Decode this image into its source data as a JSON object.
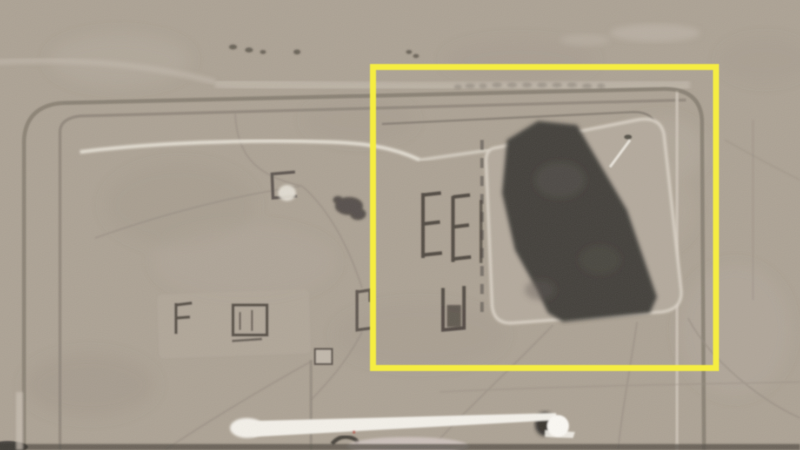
{
  "image": {
    "kind": "annotated satellite photo still",
    "alt": "Grainy monochrome overhead satellite view of a bermed desert compound with small E-shaped and U-shaped revetment structures, a large dark irregular disturbed/burned area on a lighter pad, a white dome building and a long thin white streak near the bottom. A yellow rectangle annotation highlights the dark area and adjacent structures.",
    "features": [
      "compound-perimeter-berm",
      "perimeter-road",
      "e-shaped-revetments",
      "u-shaped-revetment",
      "building-cluster",
      "dark-disturbed-area",
      "revetted-pad",
      "white-dome",
      "white-streak",
      "faint-watermark"
    ],
    "annotation": {
      "shape": "rectangle",
      "color": "#f5ed42",
      "x": 373,
      "y": 67,
      "width": 343,
      "height": 301,
      "stroke_width": 6
    },
    "colors": {
      "terrain": "#ada395",
      "terrain_light": "#bfb6a9",
      "berm_dark": "#857d72",
      "track_white": "#e9e4d9",
      "dark_area": "#45423d",
      "building_dark": "#4f4841",
      "streak_white": "#f3f0e9",
      "dome_white": "#faf8f3",
      "shadow_dark": "#35322e",
      "pink_object": "#cec2bd",
      "bottom_band": "#565149",
      "red_artifact": "#b44a3c"
    }
  }
}
